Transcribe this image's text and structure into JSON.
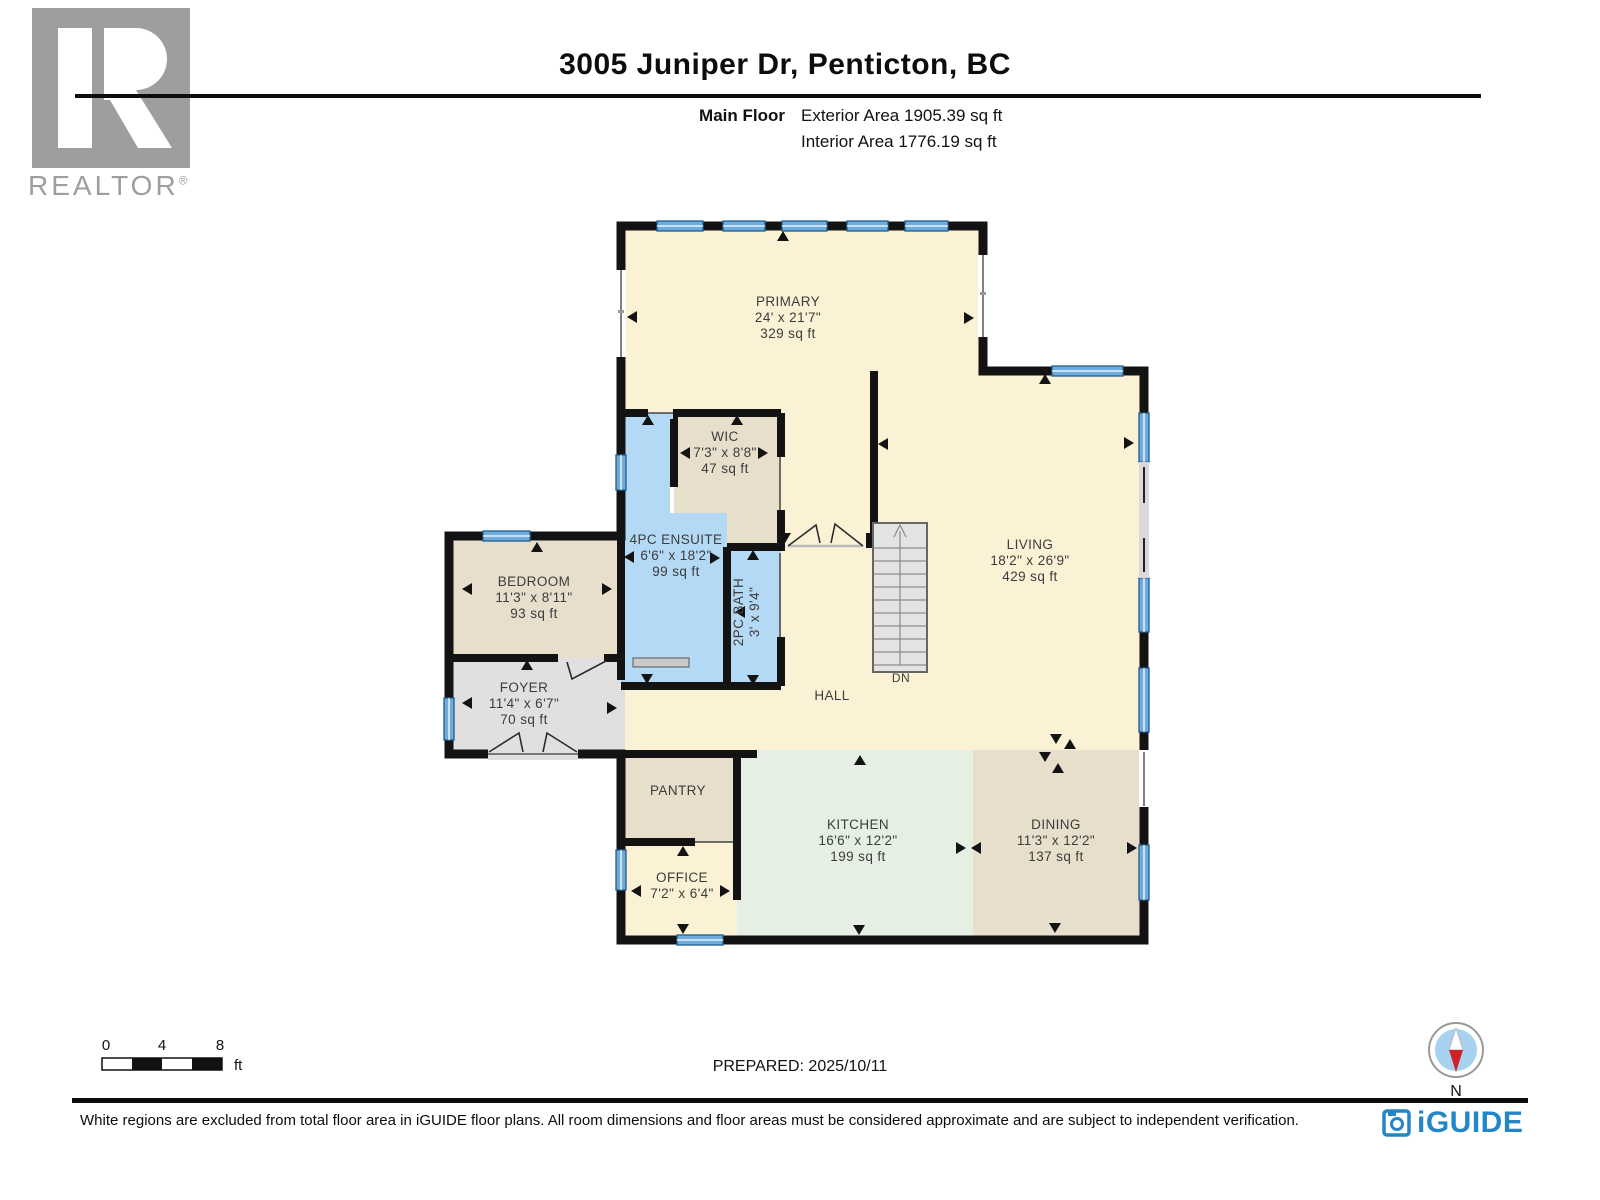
{
  "header": {
    "title": "3005 Juniper Dr, Penticton, BC",
    "floor_label": "Main Floor",
    "exterior_area": "Exterior Area 1905.39 sq ft",
    "interior_area": "Interior Area 1776.19 sq ft"
  },
  "branding": {
    "realtor_text": "REALTOR",
    "registered_mark": "®",
    "iguide_text": "iGUIDE",
    "iguide_blue": "#2386C8"
  },
  "rooms": {
    "primary": {
      "name": "PRIMARY",
      "dims": "24' x 21'7\"",
      "area": "329 sq ft"
    },
    "wic": {
      "name": "WIC",
      "dims": "7'3\" x 8'8\"",
      "area": "47 sq ft"
    },
    "ensuite": {
      "name": "4PC ENSUITE",
      "dims": "6'6\" x 18'2\"",
      "area": "99 sq ft"
    },
    "bath": {
      "name": "2PC BATH",
      "dims": "3' x 9'4\""
    },
    "bedroom": {
      "name": "BEDROOM",
      "dims": "11'3\" x 8'11\"",
      "area": "93 sq ft"
    },
    "foyer": {
      "name": "FOYER",
      "dims": "11'4\" x 6'7\"",
      "area": "70 sq ft"
    },
    "living": {
      "name": "LIVING",
      "dims": "18'2\" x 26'9\"",
      "area": "429 sq ft"
    },
    "hall": {
      "name": "HALL"
    },
    "pantry": {
      "name": "PANTRY"
    },
    "office": {
      "name": "OFFICE",
      "dims": "7'2\" x 6'4\""
    },
    "kitchen": {
      "name": "KITCHEN",
      "dims": "16'6\" x 12'2\"",
      "area": "199 sq ft"
    },
    "dining": {
      "name": "DINING",
      "dims": "11'3\" x 12'2\"",
      "area": "137 sq ft"
    },
    "stairs": {
      "label": "DN"
    }
  },
  "scale_bar": {
    "tick_0": "0",
    "tick_4": "4",
    "tick_8": "8",
    "unit": "ft"
  },
  "compass": {
    "north_label": "N"
  },
  "footer": {
    "prepared": "PREPARED: 2025/10/11",
    "disclaimer": "White regions are excluded from total floor area in iGUIDE floor plans. All room dimensions and floor areas must be considered approximate and are subject to independent verification."
  },
  "colors": {
    "wall": "#131313",
    "room_cream": "#FBF2D5",
    "room_tan": "#E7DFCC",
    "room_gray": "#E0E0E0",
    "room_blue": "#B4D9F4",
    "room_mint": "#E6EFE4",
    "window_blue": "#6FACDD",
    "label_gray": "#3C3C3C"
  }
}
